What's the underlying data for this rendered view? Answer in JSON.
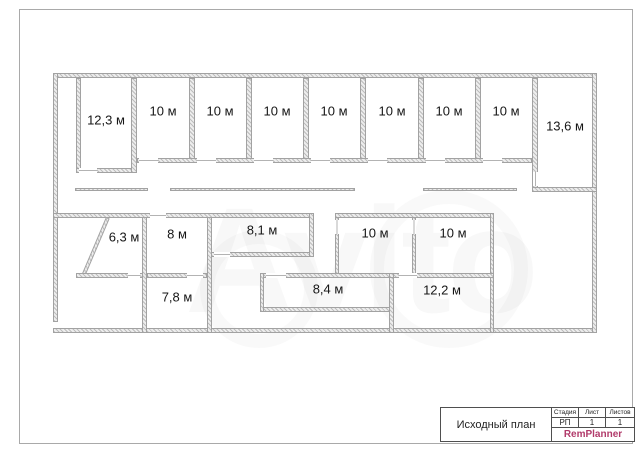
{
  "watermark": "Avito",
  "plan": {
    "rooms": [
      {
        "label": "12,3 м"
      },
      {
        "label": "10 м"
      },
      {
        "label": "10 м"
      },
      {
        "label": "10 м"
      },
      {
        "label": "10 м"
      },
      {
        "label": "10 м"
      },
      {
        "label": "10 м"
      },
      {
        "label": "10 м"
      },
      {
        "label": "13,6 м"
      },
      {
        "label": "6,3 м"
      },
      {
        "label": "8 м"
      },
      {
        "label": "8,1 м"
      },
      {
        "label": "10 м"
      },
      {
        "label": "10 м"
      },
      {
        "label": "7,8 м"
      },
      {
        "label": "8,4 м"
      },
      {
        "label": "12,2 м"
      }
    ]
  },
  "title_block": {
    "drawing_title": "Исходный план",
    "stamp": {
      "columns": [
        {
          "header": "Стадия",
          "value": "РП"
        },
        {
          "header": "Лист",
          "value": "1"
        },
        {
          "header": "Листов",
          "value": "1"
        }
      ],
      "brand": "RemPlanner",
      "brand_color": "#b13a6a"
    }
  }
}
